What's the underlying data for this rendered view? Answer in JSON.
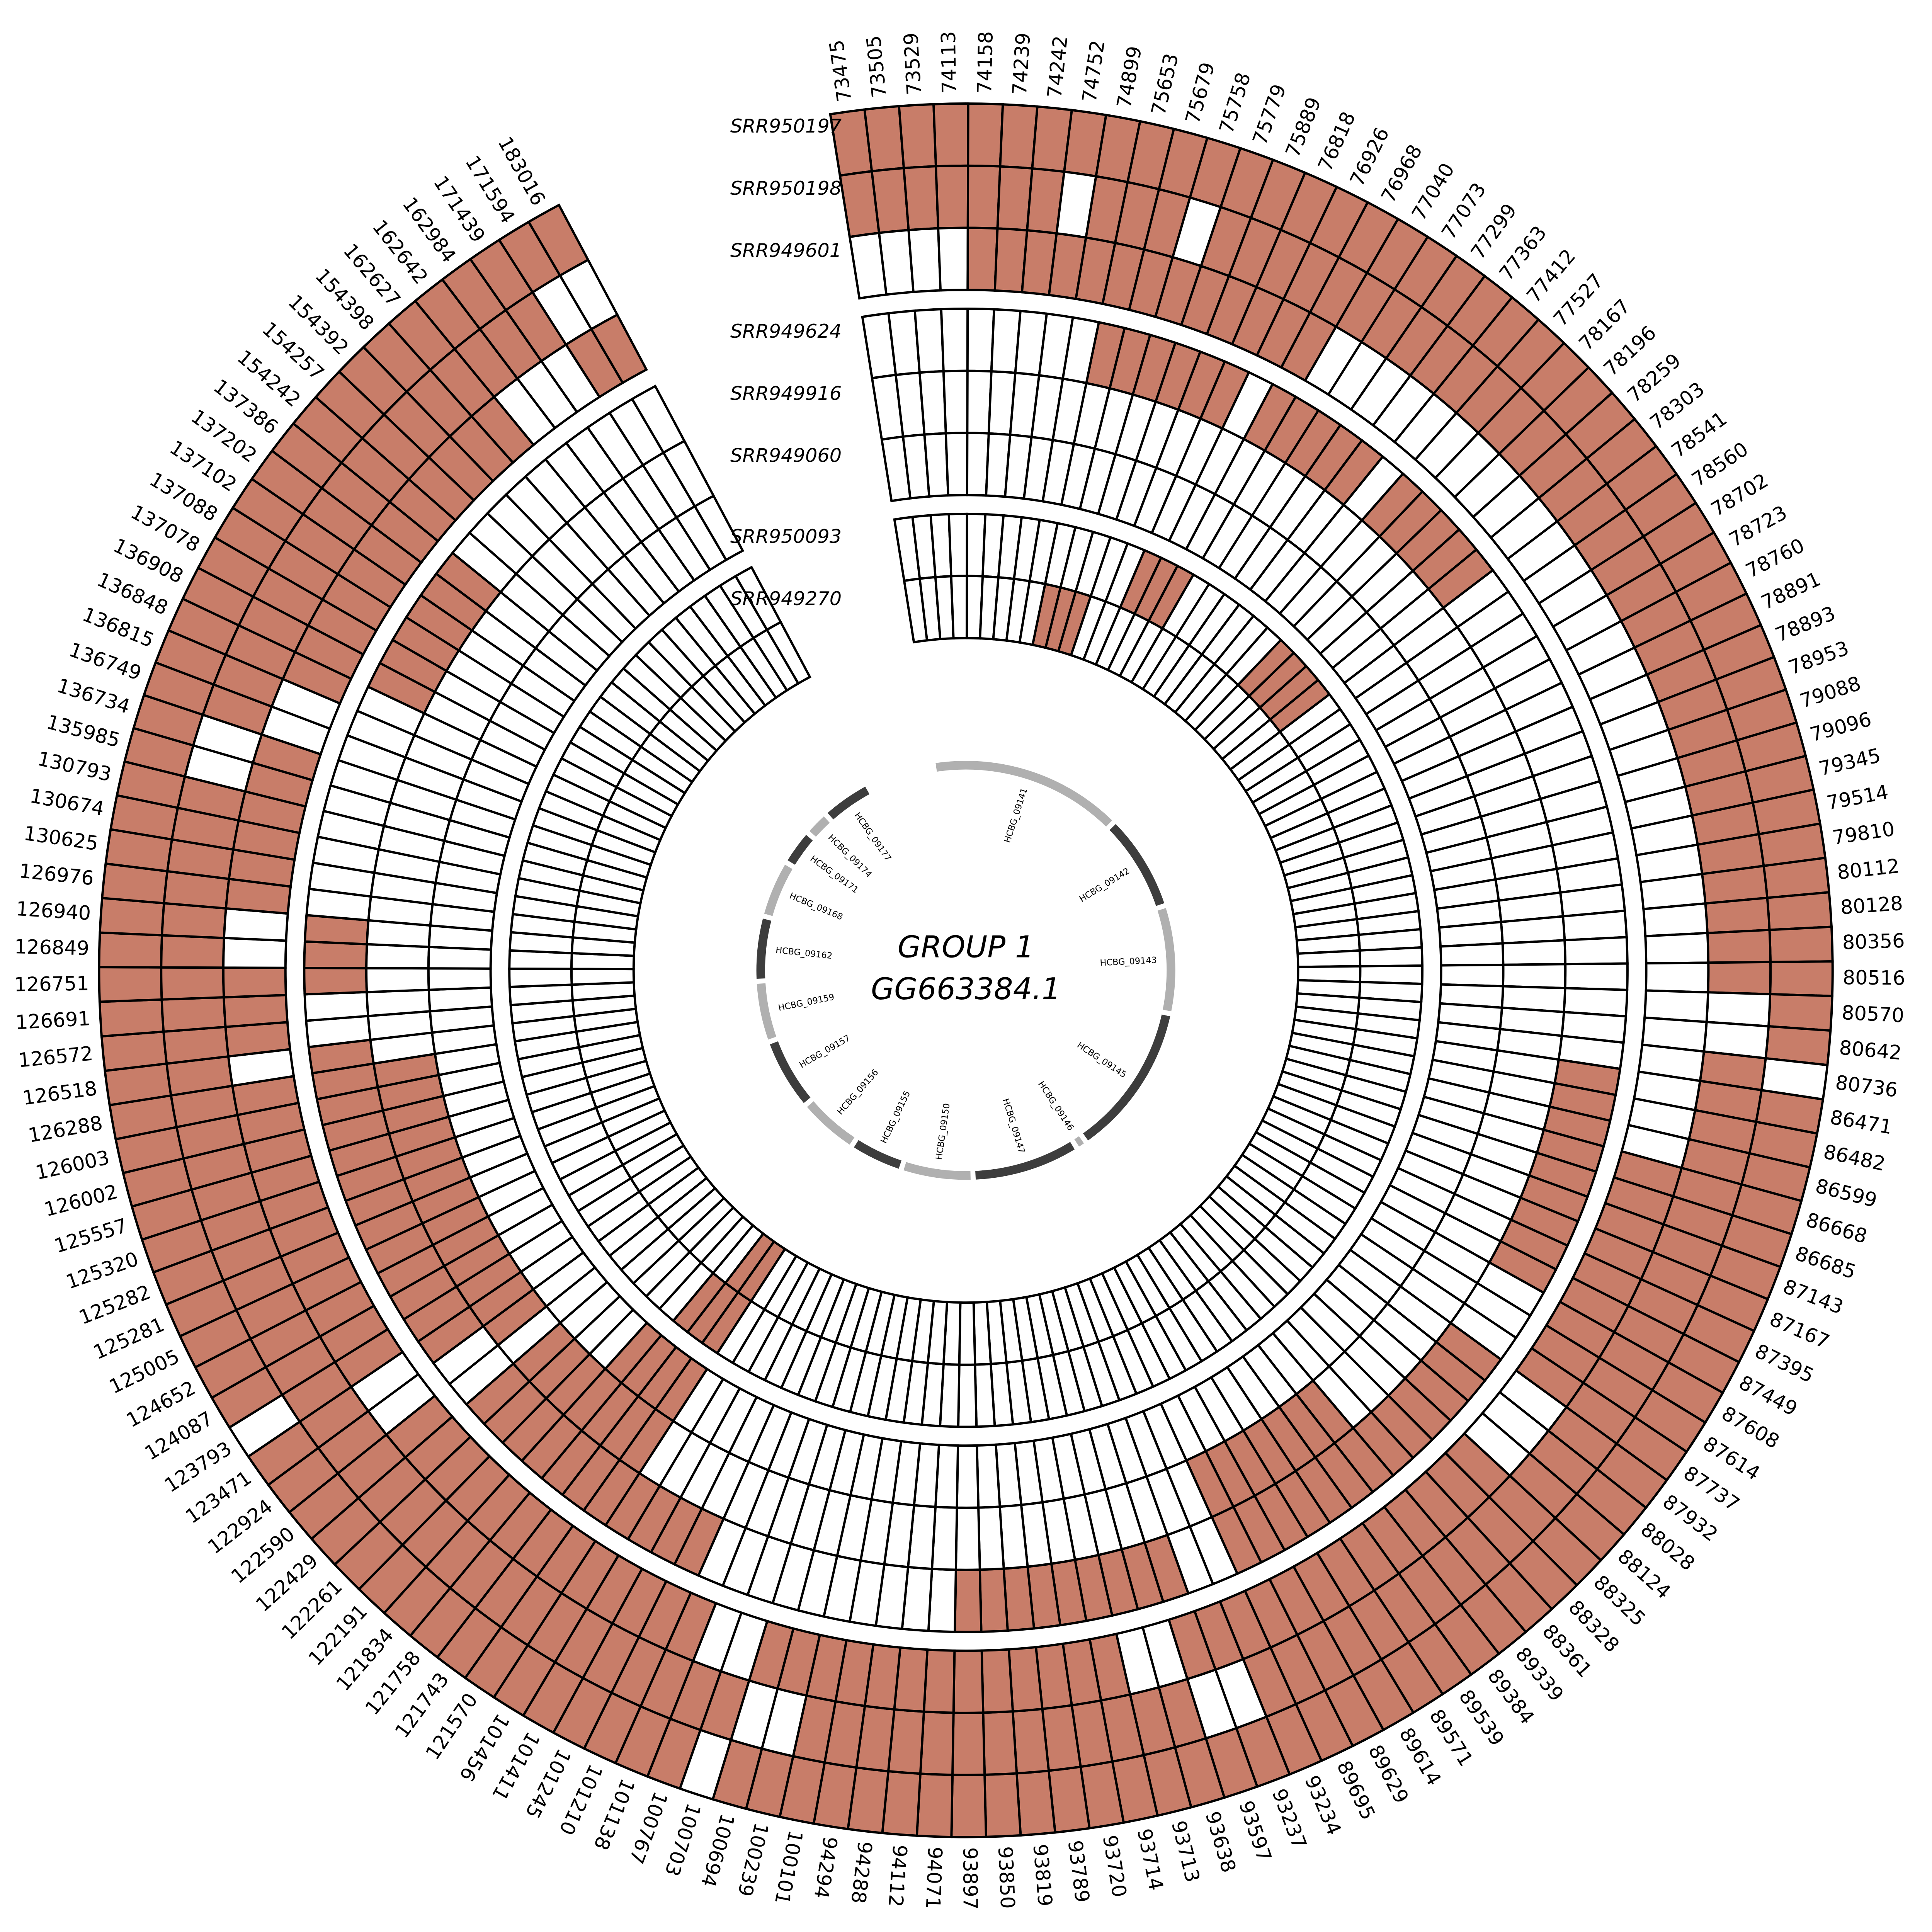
{
  "chart_data": {
    "type": "heatmap",
    "layout": "circular",
    "title": "GROUP 1",
    "subtitle": "GG663384.1",
    "legend_position": "none",
    "grid": false,
    "start_angle_deg": -99,
    "total_angle_deg": 341,
    "present_color": "#c87d69",
    "absent_color": "#ffffff",
    "cell_border_color": "#000000",
    "gene_dark_color": "#3d3d3d",
    "gene_light_color": "#b0b0b0",
    "positions": [
      "73475",
      "73505",
      "73529",
      "74113",
      "74158",
      "74239",
      "74242",
      "74752",
      "74899",
      "75653",
      "75679",
      "75758",
      "75779",
      "75889",
      "76818",
      "76926",
      "76968",
      "77040",
      "77073",
      "77299",
      "77363",
      "77412",
      "77527",
      "78167",
      "78196",
      "78259",
      "78303",
      "78541",
      "78560",
      "78702",
      "78723",
      "78760",
      "78891",
      "78893",
      "78953",
      "79088",
      "79096",
      "79345",
      "79514",
      "79810",
      "80112",
      "80128",
      "80356",
      "80516",
      "80570",
      "80642",
      "80736",
      "86471",
      "86482",
      "86599",
      "86668",
      "86685",
      "87143",
      "87167",
      "87395",
      "87449",
      "87608",
      "87614",
      "87737",
      "87932",
      "88028",
      "88124",
      "88325",
      "88328",
      "88361",
      "89339",
      "89384",
      "89539",
      "89571",
      "89614",
      "89629",
      "89695",
      "93234",
      "93237",
      "93597",
      "93638",
      "93713",
      "93714",
      "93720",
      "93789",
      "93819",
      "93850",
      "93897",
      "94071",
      "94112",
      "94288",
      "94294",
      "100101",
      "100239",
      "100694",
      "100703",
      "100767",
      "101138",
      "101210",
      "101245",
      "101411",
      "101456",
      "121570",
      "121743",
      "121758",
      "121834",
      "122191",
      "122261",
      "122429",
      "122590",
      "122924",
      "123471",
      "123793",
      "124087",
      "124652",
      "125005",
      "125281",
      "125282",
      "125320",
      "125557",
      "126002",
      "126003",
      "126288",
      "126518",
      "126572",
      "126691",
      "126751",
      "126849",
      "126940",
      "126976",
      "130625",
      "130674",
      "130793",
      "135985",
      "136734",
      "136749",
      "136815",
      "136848",
      "136908",
      "137078",
      "137088",
      "137102",
      "137202",
      "137386",
      "154242",
      "154257",
      "154392",
      "154398",
      "162627",
      "162642",
      "162984",
      "171439",
      "171594",
      "183016"
    ],
    "tracks": [
      {
        "name": "SRR950197",
        "values": "11111111111111111111111111111111111111111111110111111111111111111111111111111111111111111101111111111111111011111111111111111111111111111111111111111111"
      },
      {
        "name": "SRR950198",
        "values": "11111110111011111111111111111111111111111111001111111111111111111111111110011111111111110011111111111111111111111111111111111111001111111111111111100111"
      },
      {
        "name": "SRR949601",
        "values": "00001111111111111000000000000000000000000000000000111111111000111111111111100111111111111100111111111111100111111111110111001111110011111111111100011111"
      },
      {
        "name": "SRR949624",
        "values": "00000000011111101111101111100000000000000000000111111111000111111111111100111111111000000000011111111111001111111111111001110000000001111110000000000"
      },
      {
        "name": "SRR949916",
        "values": "00000000000000000000000000000000000000000000000000000000000000000111111100000000000000000000000001111111011111111111110000000000000000000000000000000"
      },
      {
        "name": "SRR949060",
        "values": "00000000000000000000000000000000000000000000000000000000000000000000000000000000000000000000000001111000000000000000000000000000000000000000000000000"
      },
      {
        "name": "SRR950093",
        "values": "00000000000000111000000111100000000000000000000000000000000000000000000000000000000000000000000001110000000000000000000000000000000000000000000000000"
      },
      {
        "name": "SRR949270",
        "values": "00000000011100000000000000000000000000000000000000000000000000000000000000000000000000000000000001100000000000000000000000000000000000000000000000000"
      }
    ],
    "genes": [
      {
        "name": "HCBG_09141",
        "span_deg": 54,
        "shade": "light"
      },
      {
        "name": "HCBG_09142",
        "span_deg": 27,
        "shade": "dark"
      },
      {
        "name": "HCBG_09143",
        "span_deg": 30,
        "shade": "light"
      },
      {
        "name": "HCBG_09145",
        "span_deg": 43,
        "shade": "dark"
      },
      {
        "name": "HCBG_09146",
        "span_deg": 3,
        "shade": "light"
      },
      {
        "name": "HCBG_09147",
        "span_deg": 30,
        "shade": "dark"
      },
      {
        "name": "HCBG_09150",
        "span_deg": 20,
        "shade": "light"
      },
      {
        "name": "HCBG_09155",
        "span_deg": 15,
        "shade": "dark"
      },
      {
        "name": "HCBG_09156",
        "span_deg": 17,
        "shade": "light"
      },
      {
        "name": "HCBG_09157",
        "span_deg": 20,
        "shade": "dark"
      },
      {
        "name": "HCBG_09159",
        "span_deg": 17,
        "shade": "light"
      },
      {
        "name": "HCBG_09162",
        "span_deg": 18,
        "shade": "dark"
      },
      {
        "name": "HCBG_09168",
        "span_deg": 16,
        "shade": "light"
      },
      {
        "name": "HCBG_09171",
        "span_deg": 10,
        "shade": "dark"
      },
      {
        "name": "HCBG_09174",
        "span_deg": 7,
        "shade": "light"
      },
      {
        "name": "HCBG_09177",
        "span_deg": 14,
        "shade": "dark"
      }
    ]
  }
}
